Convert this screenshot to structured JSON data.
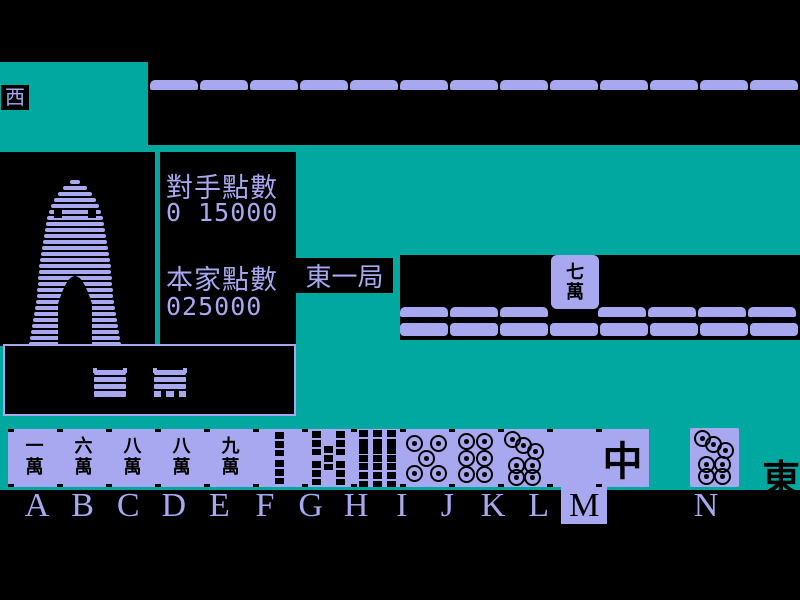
{
  "colors": {
    "teal": "#00a8a0",
    "lavender": "#a8a8f0",
    "black": "#000000"
  },
  "indicators": {
    "west_wind": "西",
    "east_wind": "東",
    "round": "東一局"
  },
  "score_panel": {
    "opponent_label": "對手點數",
    "opponent_value": "0 15000",
    "player_label": "本家點數",
    "player_value": "025000"
  },
  "discard_area": {
    "discarded_tile": {
      "top_char": "七",
      "bottom_char": "萬"
    },
    "row1_left_tiles": 3,
    "row1_right_tiles": 4,
    "row2_tiles": 8
  },
  "opponent_wall": {
    "tile_count": 13
  },
  "hand": {
    "letters": [
      "A",
      "B",
      "C",
      "D",
      "E",
      "F",
      "G",
      "H",
      "I",
      "J",
      "K",
      "L",
      "M",
      "N"
    ],
    "selected_letter": "M",
    "tiles": [
      {
        "letter": "A",
        "type": "man",
        "chars": [
          "一",
          "萬"
        ],
        "name": "1-man"
      },
      {
        "letter": "B",
        "type": "man",
        "chars": [
          "六",
          "萬"
        ],
        "name": "6-man"
      },
      {
        "letter": "C",
        "type": "man",
        "chars": [
          "八",
          "萬"
        ],
        "name": "8-man"
      },
      {
        "letter": "D",
        "type": "man",
        "chars": [
          "八",
          "萬"
        ],
        "name": "8-man"
      },
      {
        "letter": "E",
        "type": "man",
        "chars": [
          "九",
          "萬"
        ],
        "name": "9-man"
      },
      {
        "letter": "F",
        "type": "sou",
        "count": 2,
        "name": "2-sou"
      },
      {
        "letter": "G",
        "type": "sou",
        "count": 5,
        "name": "5-sou"
      },
      {
        "letter": "H",
        "type": "sou",
        "count": 9,
        "name": "9-sou"
      },
      {
        "letter": "I",
        "type": "pin",
        "count": 5,
        "name": "5-pin"
      },
      {
        "letter": "J",
        "type": "pin",
        "count": 6,
        "name": "6-pin"
      },
      {
        "letter": "K",
        "type": "pin",
        "count": 7,
        "name": "7-pin"
      },
      {
        "letter": "L",
        "type": "blank",
        "name": "white-dragon"
      },
      {
        "letter": "M",
        "type": "dragon",
        "chars": [
          "中"
        ],
        "name": "red-dragon"
      }
    ],
    "drawn_tile": {
      "letter": "N",
      "type": "pin",
      "count": 7,
      "name": "7-pin"
    }
  }
}
